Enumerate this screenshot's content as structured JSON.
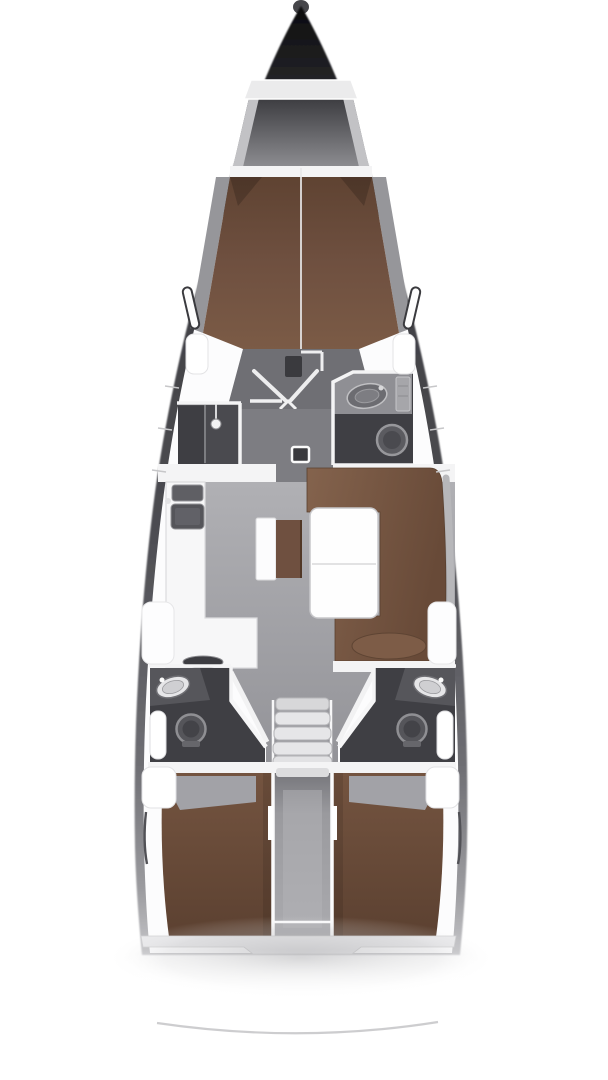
{
  "diagram": {
    "title": "Sailing yacht interior layout plan, top-down view, bow at top and stern at bottom",
    "type": "boat-floor-plan",
    "orientation": {
      "bow": "top",
      "stern": "bottom"
    },
    "colors": {
      "background": "#ffffff",
      "hull": "#2e2e32",
      "deck": "#fcfcfd",
      "floor_salon": "#a4a4a8",
      "floor_cabin": "#6f6f74",
      "floor_corridor": "#7d7d82",
      "room_dark": "#3f3f44",
      "room_shadow": "#4a4a4f",
      "counter_gray": "#8f8f94",
      "cushion_brown": "#6f5040",
      "cushion_brown_dark": "#5c4131",
      "cushion_brown_light": "#7d5c47",
      "furniture_white": "#f7f7f8",
      "wall_white": "#f4f4f5",
      "fixture_gray": "#9a9a9e"
    },
    "areas": [
      {
        "id": "anchor-locker",
        "label": "Anchor locker at bow"
      },
      {
        "id": "forepeak-shelf",
        "label": "Forepeak storage shelf"
      },
      {
        "id": "forward-cabin",
        "label": "Forward cabin with V-berth double mattress"
      },
      {
        "id": "forward-shower",
        "label": "Forward shower compartment, port side"
      },
      {
        "id": "forward-head",
        "label": "Forward head with washbasin and toilet, starboard side"
      },
      {
        "id": "salon",
        "label": "Salon with U-shaped settee, folding table and bench seat"
      },
      {
        "id": "galley",
        "label": "L-shaped galley with sink and stove, port side"
      },
      {
        "id": "companionway",
        "label": "Companionway steps to cockpit"
      },
      {
        "id": "aft-head-port",
        "label": "Aft head with washbasin and toilet, port side"
      },
      {
        "id": "aft-head-starboard",
        "label": "Aft head with washbasin and toilet, starboard side"
      },
      {
        "id": "engine-compartment",
        "label": "Engine compartment between aft cabins"
      },
      {
        "id": "aft-cabin-port",
        "label": "Aft cabin with double berth, port side"
      },
      {
        "id": "aft-cabin-starboard",
        "label": "Aft cabin with double berth, starboard side"
      },
      {
        "id": "transom",
        "label": "Stern transom arc"
      }
    ],
    "fixtures": {
      "sinks": 4,
      "toilets": 3,
      "berths": 3,
      "companionway_steps": 5,
      "tables": 1
    }
  }
}
